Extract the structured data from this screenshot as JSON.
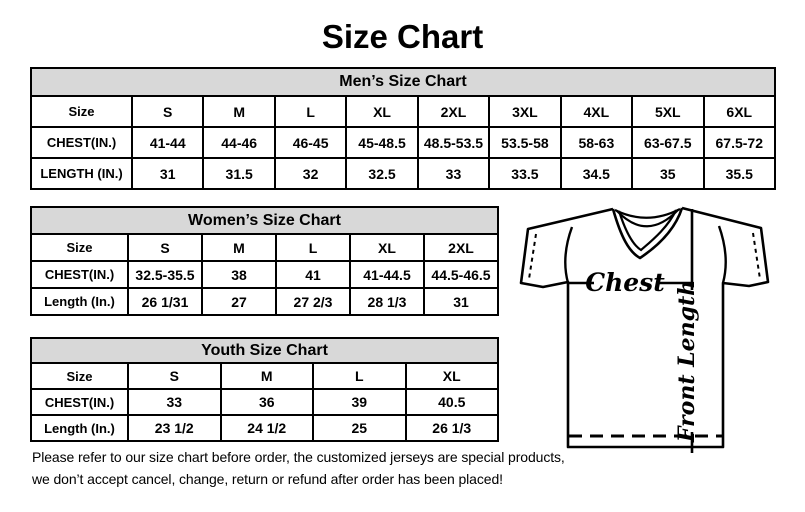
{
  "page": {
    "title": "Size Chart"
  },
  "colors": {
    "table_header_bg": "#d8d8d8",
    "border": "#000000",
    "text": "#000000",
    "background": "#ffffff"
  },
  "tables": {
    "men": {
      "title": "Men’s Size Chart",
      "rows": [
        [
          "Size",
          "S",
          "M",
          "L",
          "XL",
          "2XL",
          "3XL",
          "4XL",
          "5XL",
          "6XL"
        ],
        [
          "CHEST(IN.)",
          "41-44",
          "44-46",
          "46-45",
          "45-48.5",
          "48.5-53.5",
          "53.5-58",
          "58-63",
          "63-67.5",
          "67.5-72"
        ],
        [
          "LENGTH (IN.)",
          "31",
          "31.5",
          "32",
          "32.5",
          "33",
          "33.5",
          "34.5",
          "35",
          "35.5"
        ]
      ]
    },
    "women": {
      "title": "Women’s Size Chart",
      "rows": [
        [
          "Size",
          "S",
          "M",
          "L",
          "XL",
          "2XL"
        ],
        [
          "CHEST(IN.)",
          "32.5-35.5",
          "38",
          "41",
          "41-44.5",
          "44.5-46.5"
        ],
        [
          "Length (In.)",
          "26 1/31",
          "27",
          "27 2/3",
          "28 1/3",
          "31"
        ]
      ]
    },
    "youth": {
      "title": "Youth Size Chart",
      "rows": [
        [
          "Size",
          "S",
          "M",
          "L",
          "XL"
        ],
        [
          "CHEST(IN.)",
          "33",
          "36",
          "39",
          "40.5"
        ],
        [
          "Length (In.)",
          "23 1/2",
          "24 1/2",
          "25",
          "26 1/3"
        ]
      ]
    }
  },
  "diagram": {
    "chest_label": "Chest",
    "front_length_label": "Front Length"
  },
  "disclaimer": {
    "line1": "Please refer to our size chart before order, the customized jerseys are special products,",
    "line2": "we don’t accept cancel, change, return or refund after order has been placed!"
  }
}
